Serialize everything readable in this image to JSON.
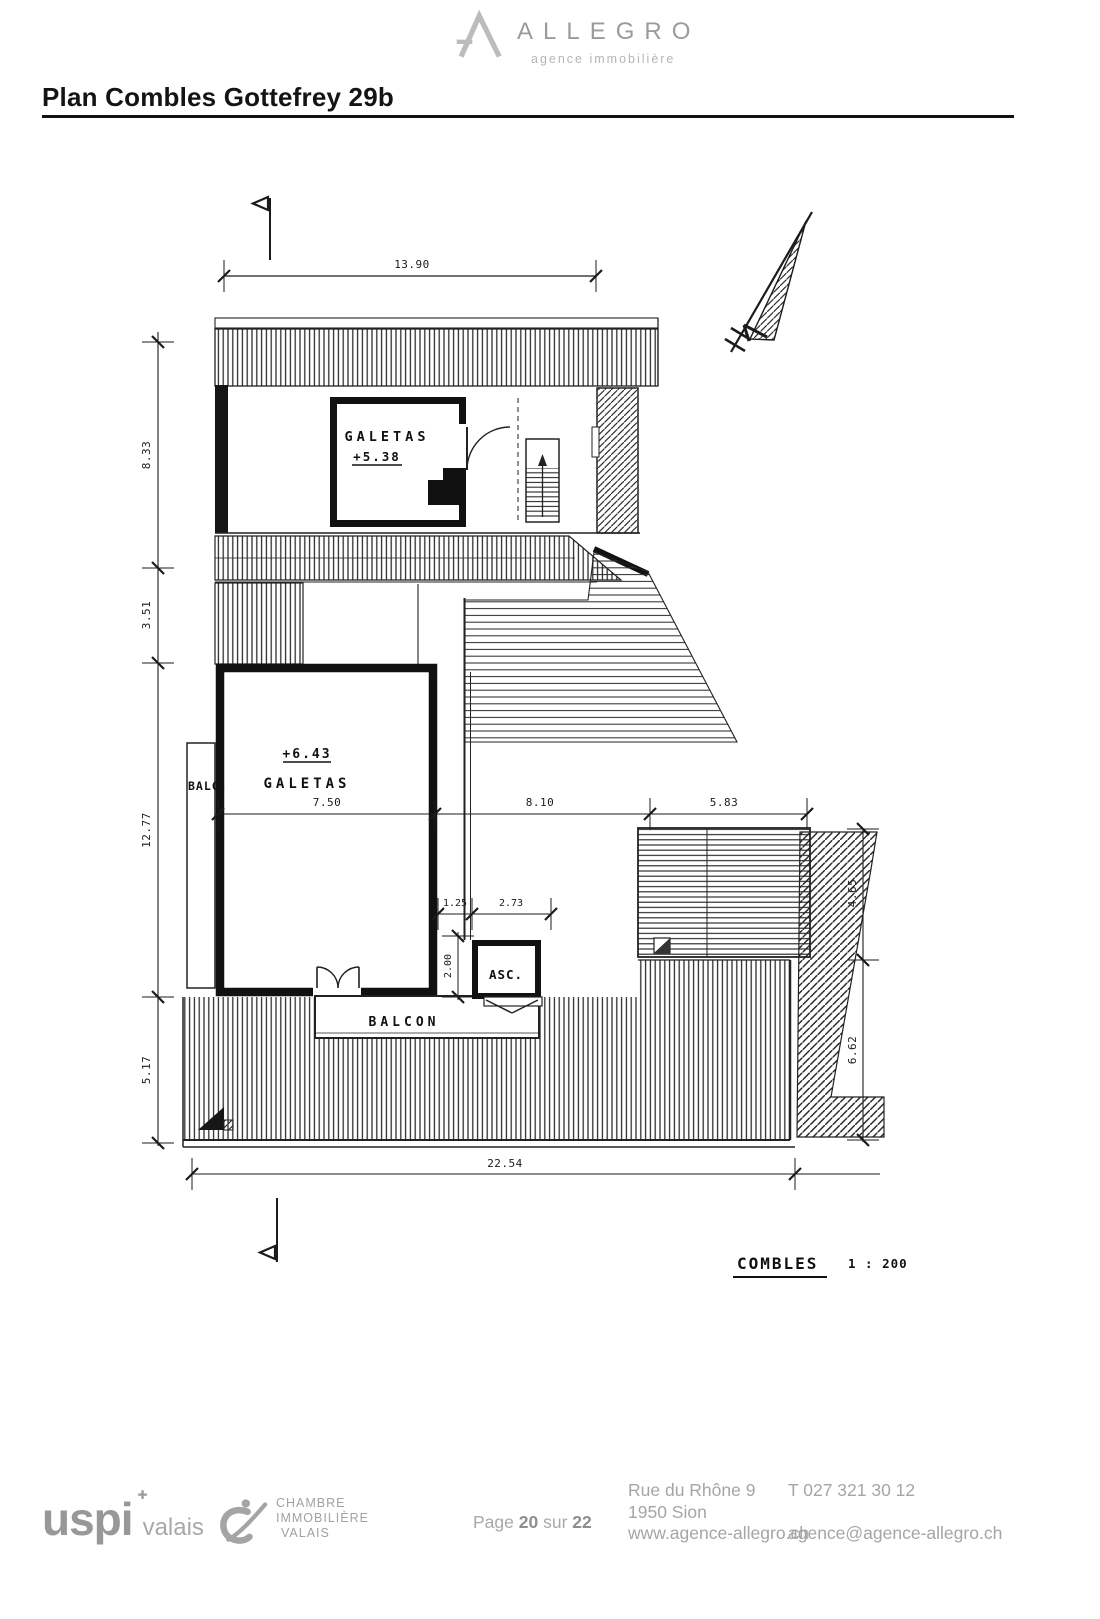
{
  "header": {
    "brand": "ALLEGRO",
    "tagline": "agence immobilière"
  },
  "title": "Plan Combles Gottefrey 29b",
  "plan": {
    "labels": {
      "galetas_upper": "GALETAS",
      "level_upper": "+5.38",
      "level_lower": "+6.43",
      "galetas_lower": "GALETAS",
      "balc": "BALC.",
      "asc": "ASC.",
      "balcon": "BALCON"
    },
    "dims": {
      "top": "13.90",
      "left1": "8.33",
      "left2": "3.51",
      "left3": "12.77",
      "left4": "5.17",
      "w1": "7.50",
      "w2": "8.10",
      "w3": "5.83",
      "asc1": "1.25",
      "asc2": "2.73",
      "ascv": "2.00",
      "right1": "4.65",
      "right2": "6.62",
      "bottom": "22.54"
    },
    "caption": {
      "name": "COMBLES",
      "scale": "1 : 200"
    }
  },
  "footer": {
    "uspi_name": "uspi",
    "uspi_region": "valais",
    "civ": {
      "l1": "CHAMBRE",
      "l2": "IMMOBILIÈRE",
      "l3": "VALAIS"
    },
    "page": {
      "label": "Page",
      "num": "20",
      "sep": "sur",
      "total": "22"
    },
    "address": {
      "l1": "Rue du Rhône 9",
      "l2": "1950 Sion",
      "l3": "www.agence-allegro.ch"
    },
    "contact": {
      "phone": "T 027 321 30 12",
      "email": "agence@agence-allegro.ch"
    }
  },
  "colors": {
    "ink": "#1b1b1b",
    "gray_logo": "#a4a4a6",
    "gray_text": "#a5a5a7"
  }
}
